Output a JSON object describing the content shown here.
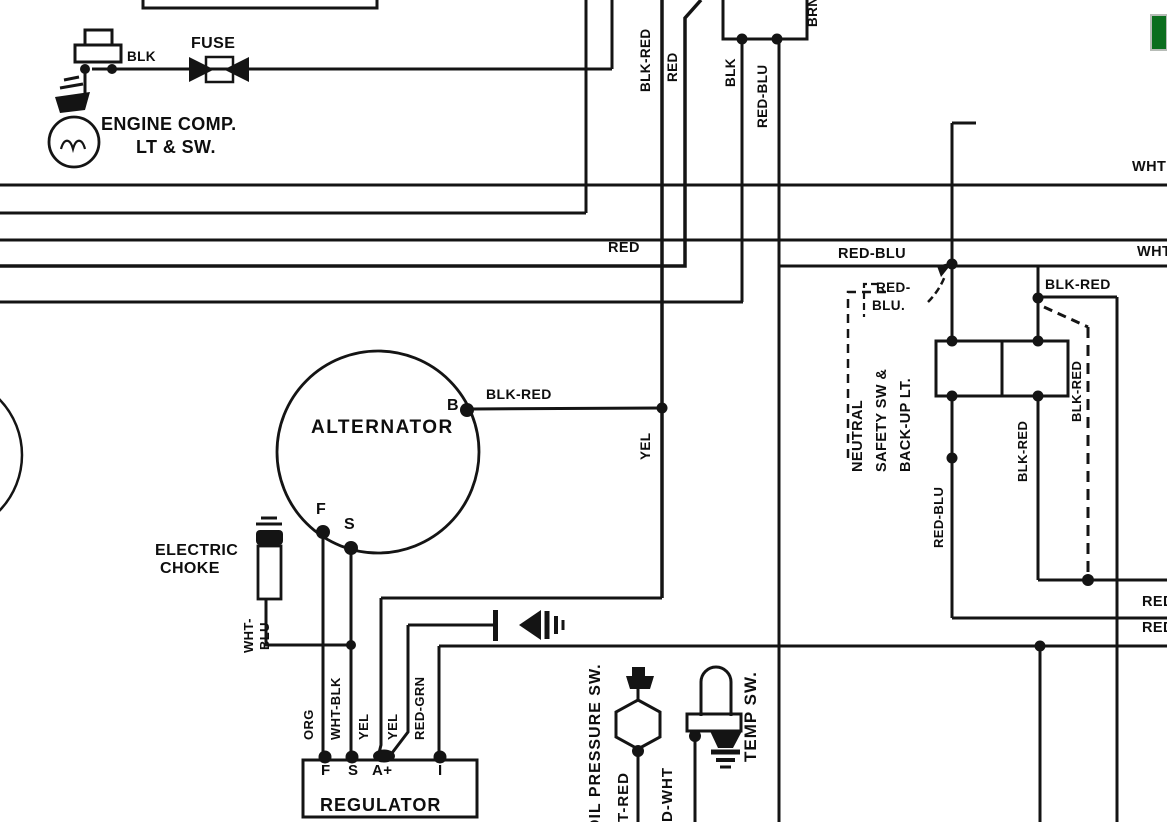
{
  "meta": {
    "type": "automotive wiring diagram (scanned, black & white)",
    "colors": {
      "line": "#141414",
      "background": "#ffffff",
      "green_marker": "#0b6e1e",
      "green_border": "#b7bcb7"
    }
  },
  "components": {
    "alternator": {
      "name": "ALTERNATOR",
      "terminals": [
        "B",
        "F",
        "S"
      ]
    },
    "regulator": {
      "name": "REGULATOR",
      "terminals": [
        "F",
        "S",
        "A+",
        "I"
      ]
    },
    "fuse": {
      "name": "FUSE"
    },
    "engine_comp_light": {
      "name": "ENGINE COMP. LT & SW."
    },
    "electric_choke": {
      "name": "ELECTRIC CHOKE"
    },
    "oil_pressure_switch": {
      "name": "OIL PRESSURE SW."
    },
    "temp_switch": {
      "name": "TEMP SW."
    },
    "neutral_safety_switch": {
      "name": "NEUTRAL SAFETY SW & BACK-UP LT."
    }
  },
  "labels": [
    {
      "name": "fuse-label",
      "text": "FUSE",
      "x": 191,
      "y": 36,
      "rot": 0,
      "size": 16
    },
    {
      "name": "blk-fuse-wire-label",
      "text": "BLK",
      "x": 127,
      "y": 50,
      "rot": 0,
      "size": 13.5
    },
    {
      "name": "engine-comp-label-line1",
      "text": "ENGINE COMP.",
      "x": 101,
      "y": 115,
      "rot": 0,
      "size": 18
    },
    {
      "name": "engine-comp-label-line2",
      "text": "LT & SW.",
      "x": 136,
      "y": 138,
      "rot": 0,
      "size": 18
    },
    {
      "name": "blk-red-top-wire-label",
      "text": "BLK-RED",
      "x": 639,
      "y": 92,
      "rot": -90,
      "size": 13.5
    },
    {
      "name": "red-top-wire-label",
      "text": "RED",
      "x": 666,
      "y": 82,
      "rot": -90,
      "size": 13.5
    },
    {
      "name": "brn-wire-label",
      "text": "BRN",
      "x": 806,
      "y": 27,
      "rot": -90,
      "size": 13.5
    },
    {
      "name": "blk-drop-wire-label",
      "text": "BLK",
      "x": 724,
      "y": 87,
      "rot": -90,
      "size": 13.5
    },
    {
      "name": "red-blu-drop-wire-label",
      "text": "RED-BLU",
      "x": 756,
      "y": 128,
      "rot": -90,
      "size": 13.5
    },
    {
      "name": "red-bus-label",
      "text": "RED",
      "x": 608,
      "y": 241,
      "rot": 0,
      "size": 14.5
    },
    {
      "name": "red-blu-bus-label",
      "text": "RED-BLU",
      "x": 838,
      "y": 247,
      "rot": 0,
      "size": 14.5
    },
    {
      "name": "wht-right-label-top",
      "text": "WHT",
      "x": 1132,
      "y": 160,
      "rot": 0,
      "size": 14.5
    },
    {
      "name": "wht-right-label-mid",
      "text": "WHT",
      "x": 1137,
      "y": 245,
      "rot": 0,
      "size": 14.5
    },
    {
      "name": "blk-red-right-label",
      "text": "BLK-RED",
      "x": 1045,
      "y": 277,
      "rot": 0,
      "size": 14
    },
    {
      "name": "red-blu-callout-line1",
      "text": "RED-",
      "x": 876,
      "y": 281,
      "rot": 0,
      "size": 13.5
    },
    {
      "name": "red-blu-callout-line2",
      "text": "BLU.",
      "x": 872,
      "y": 299,
      "rot": 0,
      "size": 13.5
    },
    {
      "name": "neutral-safety-label-line1",
      "text": "NEUTRAL",
      "x": 851,
      "y": 472,
      "rot": -90,
      "size": 14.5
    },
    {
      "name": "neutral-safety-label-line2",
      "text": "SAFETY SW &",
      "x": 875,
      "y": 472,
      "rot": -90,
      "size": 14.5
    },
    {
      "name": "neutral-safety-label-line3",
      "text": "BACK-UP LT.",
      "x": 899,
      "y": 472,
      "rot": -90,
      "size": 14.5
    },
    {
      "name": "alternator-label",
      "text": "ALTERNATOR",
      "x": 311,
      "y": 418,
      "rot": 0,
      "size": 19,
      "ls": 1.5
    },
    {
      "name": "terminal-b-label",
      "text": "B",
      "x": 447,
      "y": 398,
      "rot": 0,
      "size": 16
    },
    {
      "name": "blk-red-b-wire-label",
      "text": "BLK-RED",
      "x": 486,
      "y": 387,
      "rot": 0,
      "size": 14
    },
    {
      "name": "yel-wire-label",
      "text": "YEL",
      "x": 639,
      "y": 460,
      "rot": -90,
      "size": 13.5
    },
    {
      "name": "terminal-f-label",
      "text": "F",
      "x": 316,
      "y": 502,
      "rot": 0,
      "size": 16
    },
    {
      "name": "terminal-s-label",
      "text": "S",
      "x": 344,
      "y": 517,
      "rot": 0,
      "size": 16
    },
    {
      "name": "electric-choke-label-line1",
      "text": "ELECTRIC",
      "x": 155,
      "y": 543,
      "rot": 0,
      "size": 16
    },
    {
      "name": "electric-choke-label-line2",
      "text": "CHOKE",
      "x": 160,
      "y": 561,
      "rot": 0,
      "size": 16
    },
    {
      "name": "wht-choke-wire-label",
      "text": "WHT-",
      "x": 242,
      "y": 653,
      "rot": -90,
      "size": 13
    },
    {
      "name": "blu-choke-wire-label",
      "text": "BLU",
      "x": 258,
      "y": 650,
      "rot": -90,
      "size": 13
    },
    {
      "name": "org-wire-label",
      "text": "ORG",
      "x": 302,
      "y": 740,
      "rot": -90,
      "size": 13
    },
    {
      "name": "wht-blk-wire-label",
      "text": "WHT-BLK",
      "x": 329,
      "y": 740,
      "rot": -90,
      "size": 13
    },
    {
      "name": "yel1-wire-label",
      "text": "YEL",
      "x": 357,
      "y": 740,
      "rot": -90,
      "size": 13
    },
    {
      "name": "yel2-wire-label",
      "text": "YEL",
      "x": 386,
      "y": 740,
      "rot": -90,
      "size": 13
    },
    {
      "name": "red-grn-wire-label",
      "text": "RED-GRN",
      "x": 413,
      "y": 740,
      "rot": -90,
      "size": 13
    },
    {
      "name": "regulator-terminal-f-label",
      "text": "F",
      "x": 321,
      "y": 763,
      "rot": 0,
      "size": 15
    },
    {
      "name": "regulator-terminal-s-label",
      "text": "S",
      "x": 348,
      "y": 763,
      "rot": 0,
      "size": 15
    },
    {
      "name": "regulator-terminal-aplus-label",
      "text": "A+",
      "x": 372,
      "y": 763,
      "rot": 0,
      "size": 15
    },
    {
      "name": "regulator-terminal-i-label",
      "text": "I",
      "x": 438,
      "y": 763,
      "rot": 0,
      "size": 15
    },
    {
      "name": "regulator-label",
      "text": "REGULATOR",
      "x": 320,
      "y": 796,
      "rot": 0,
      "size": 18,
      "ls": 1
    },
    {
      "name": "oil-pressure-sw-label",
      "text": "OIL PRESSURE SW.",
      "x": 588,
      "y": 832,
      "rot": -90,
      "size": 16,
      "ls": 1
    },
    {
      "name": "t-red-wire-label",
      "text": "T-RED",
      "x": 616,
      "y": 822,
      "rot": -90,
      "size": 15,
      "ls": 1
    },
    {
      "name": "d-wht-wire-label",
      "text": "D-WHT",
      "x": 660,
      "y": 822,
      "rot": -90,
      "size": 15,
      "ls": 1
    },
    {
      "name": "temp-sw-label",
      "text": "TEMP SW.",
      "x": 742,
      "y": 762,
      "rot": -90,
      "size": 17,
      "ls": 1
    },
    {
      "name": "red-blu-nsw-wire-label",
      "text": "RED-BLU",
      "x": 932,
      "y": 548,
      "rot": -90,
      "size": 13
    },
    {
      "name": "blk-red-nsw-wire-label",
      "text": "BLK-RED",
      "x": 1016,
      "y": 482,
      "rot": -90,
      "size": 13
    },
    {
      "name": "blk-red-dashed-wire-label",
      "text": "BLK-RED",
      "x": 1070,
      "y": 422,
      "rot": -90,
      "size": 13
    },
    {
      "name": "red-right-label-top",
      "text": "RED",
      "x": 1142,
      "y": 595,
      "rot": 0,
      "size": 14.5
    },
    {
      "name": "red-right-label-bottom",
      "text": "RED",
      "x": 1142,
      "y": 621,
      "rot": 0,
      "size": 14.5
    }
  ]
}
